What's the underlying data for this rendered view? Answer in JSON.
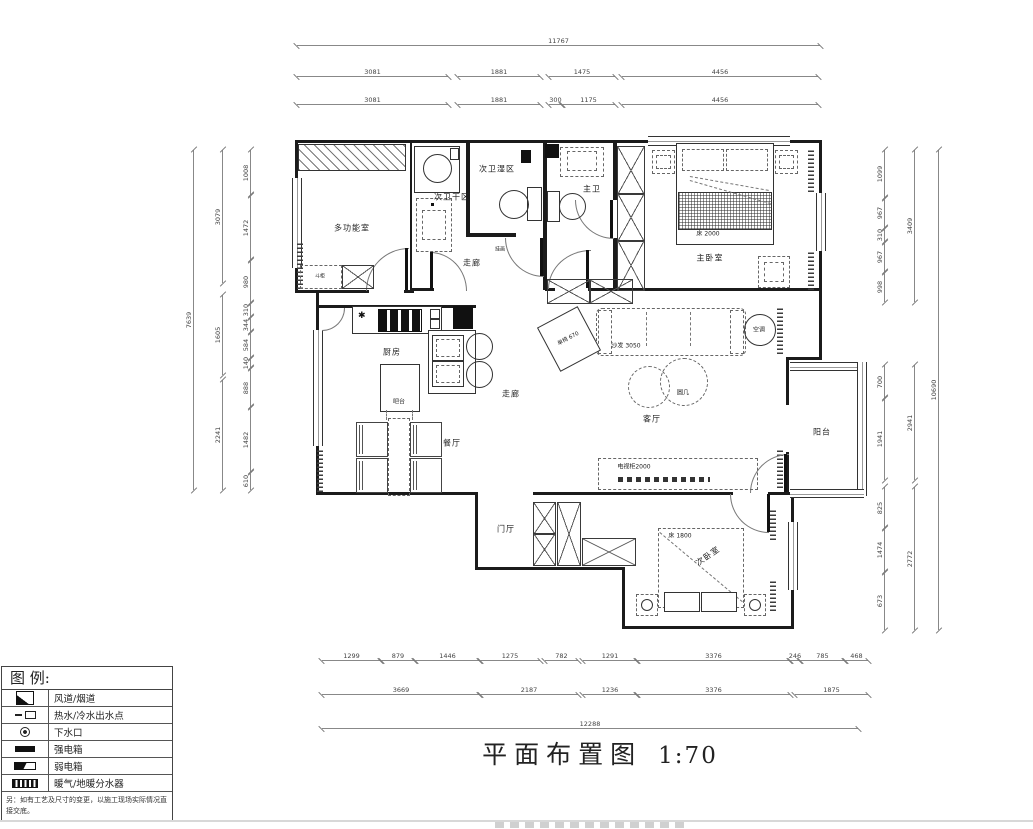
{
  "title": {
    "text": "平面布置图",
    "scale": "1:70"
  },
  "legend": {
    "header": "图 例:",
    "items": [
      {
        "symbol": "flue",
        "label": "风道/烟道"
      },
      {
        "symbol": "water-outlet",
        "label": "热水/冷水出水点"
      },
      {
        "symbol": "drain",
        "label": "下水口"
      },
      {
        "symbol": "strong-power-box",
        "label": "强电箱"
      },
      {
        "symbol": "weak-power-box",
        "label": "弱电箱"
      },
      {
        "symbol": "heating-manifold",
        "label": "暖气/地暖分水器"
      }
    ],
    "note": "另：如有工艺及尺寸的变更，以施工现场实际情况直接交底。"
  },
  "rooms": {
    "multi": "多功能室",
    "bath2_dry": "次卫干区",
    "bath2_wet": "次卫湿区",
    "bath1": "主卫",
    "master": "主卧室",
    "kitchen": "厨房",
    "bar": "吧台",
    "dining": "餐厅",
    "corridor_a": "走廊",
    "corridor_b": "走廊",
    "living": "客厅",
    "balcony": "阳台",
    "foyer": "门厅",
    "bed2": "次卧室",
    "art": "挂画",
    "chest": "斗柜"
  },
  "furniture": {
    "bed_master": "床 2000",
    "bed_second": "床 1800",
    "sofa": "沙发 3050",
    "chair": "单椅 670",
    "tv": "电视柜2000",
    "ac": "空调",
    "round_table": "圆几"
  },
  "symbols": {
    "star": "✱"
  },
  "dims": {
    "top_total": [
      "11767"
    ],
    "top_row2": [
      "3081",
      "1881",
      "1475",
      "4456"
    ],
    "top_row3": [
      "3081",
      "1881",
      "300",
      "1175",
      "4456"
    ],
    "bottom_row1": [
      "1299",
      "879",
      "1446",
      "1275",
      "782",
      "1291",
      "3376",
      "246",
      "785",
      "468"
    ],
    "bottom_row2": [
      "3669",
      "2187",
      "1236",
      "3376",
      "1875"
    ],
    "bottom_total": [
      "12288"
    ],
    "left_outer": [
      "7639"
    ],
    "left_mid": [
      "3079",
      "1605",
      "2241"
    ],
    "left_inner": [
      "1008",
      "1472",
      "980",
      "310",
      "344",
      "584",
      "140",
      "888",
      "1482",
      "610"
    ],
    "right_outer": [
      "10690"
    ],
    "right_mid": [
      "3409",
      "2941",
      "2772"
    ],
    "right_inner": [
      "1099",
      "967",
      "310",
      "967",
      "998",
      "700",
      "1941",
      "825",
      "1474",
      "673"
    ]
  }
}
